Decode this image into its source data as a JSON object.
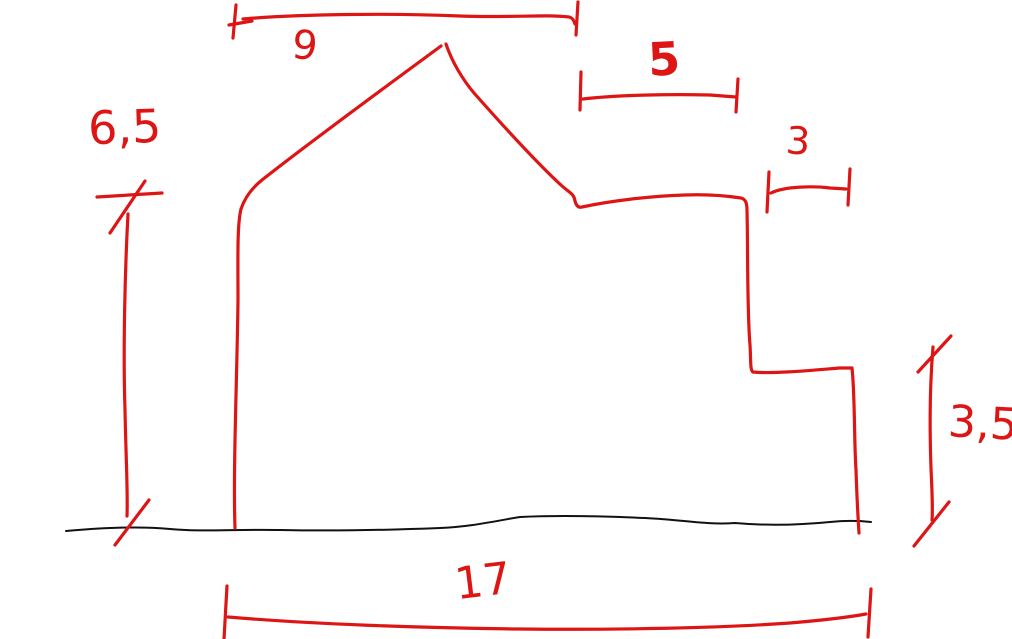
{
  "canvas": {
    "width": 1012,
    "height": 639,
    "background": "#ffffff"
  },
  "colors": {
    "ink_red": "#dd1515",
    "ink_black": "#111111"
  },
  "sketch": {
    "kind": "freehand pen sketch with dimension lines",
    "subject": "stepped house / building side-profile outline standing on a ground line",
    "dimensions": [
      {
        "id": "roof-top-width",
        "label": "9",
        "value": 9,
        "orientation": "horizontal",
        "location": "top edge, from left wall to right of roof peak"
      },
      {
        "id": "upper-right-width",
        "label": "5",
        "value": 5,
        "orientation": "horizontal",
        "location": "upper right, above the lower flat roofline"
      },
      {
        "id": "step-width",
        "label": "3",
        "value": 3,
        "orientation": "horizontal",
        "location": "right side, above the stepped ledge"
      },
      {
        "id": "left-height",
        "label": "6,5",
        "value": 6.5,
        "orientation": "vertical",
        "location": "left of the tall left wall"
      },
      {
        "id": "right-height",
        "label": "3,5",
        "value": 3.5,
        "orientation": "vertical",
        "location": "right of the low right wall"
      },
      {
        "id": "total-width",
        "label": "17",
        "value": 17,
        "orientation": "horizontal",
        "location": "bottom, full building width below the ground line"
      }
    ]
  }
}
